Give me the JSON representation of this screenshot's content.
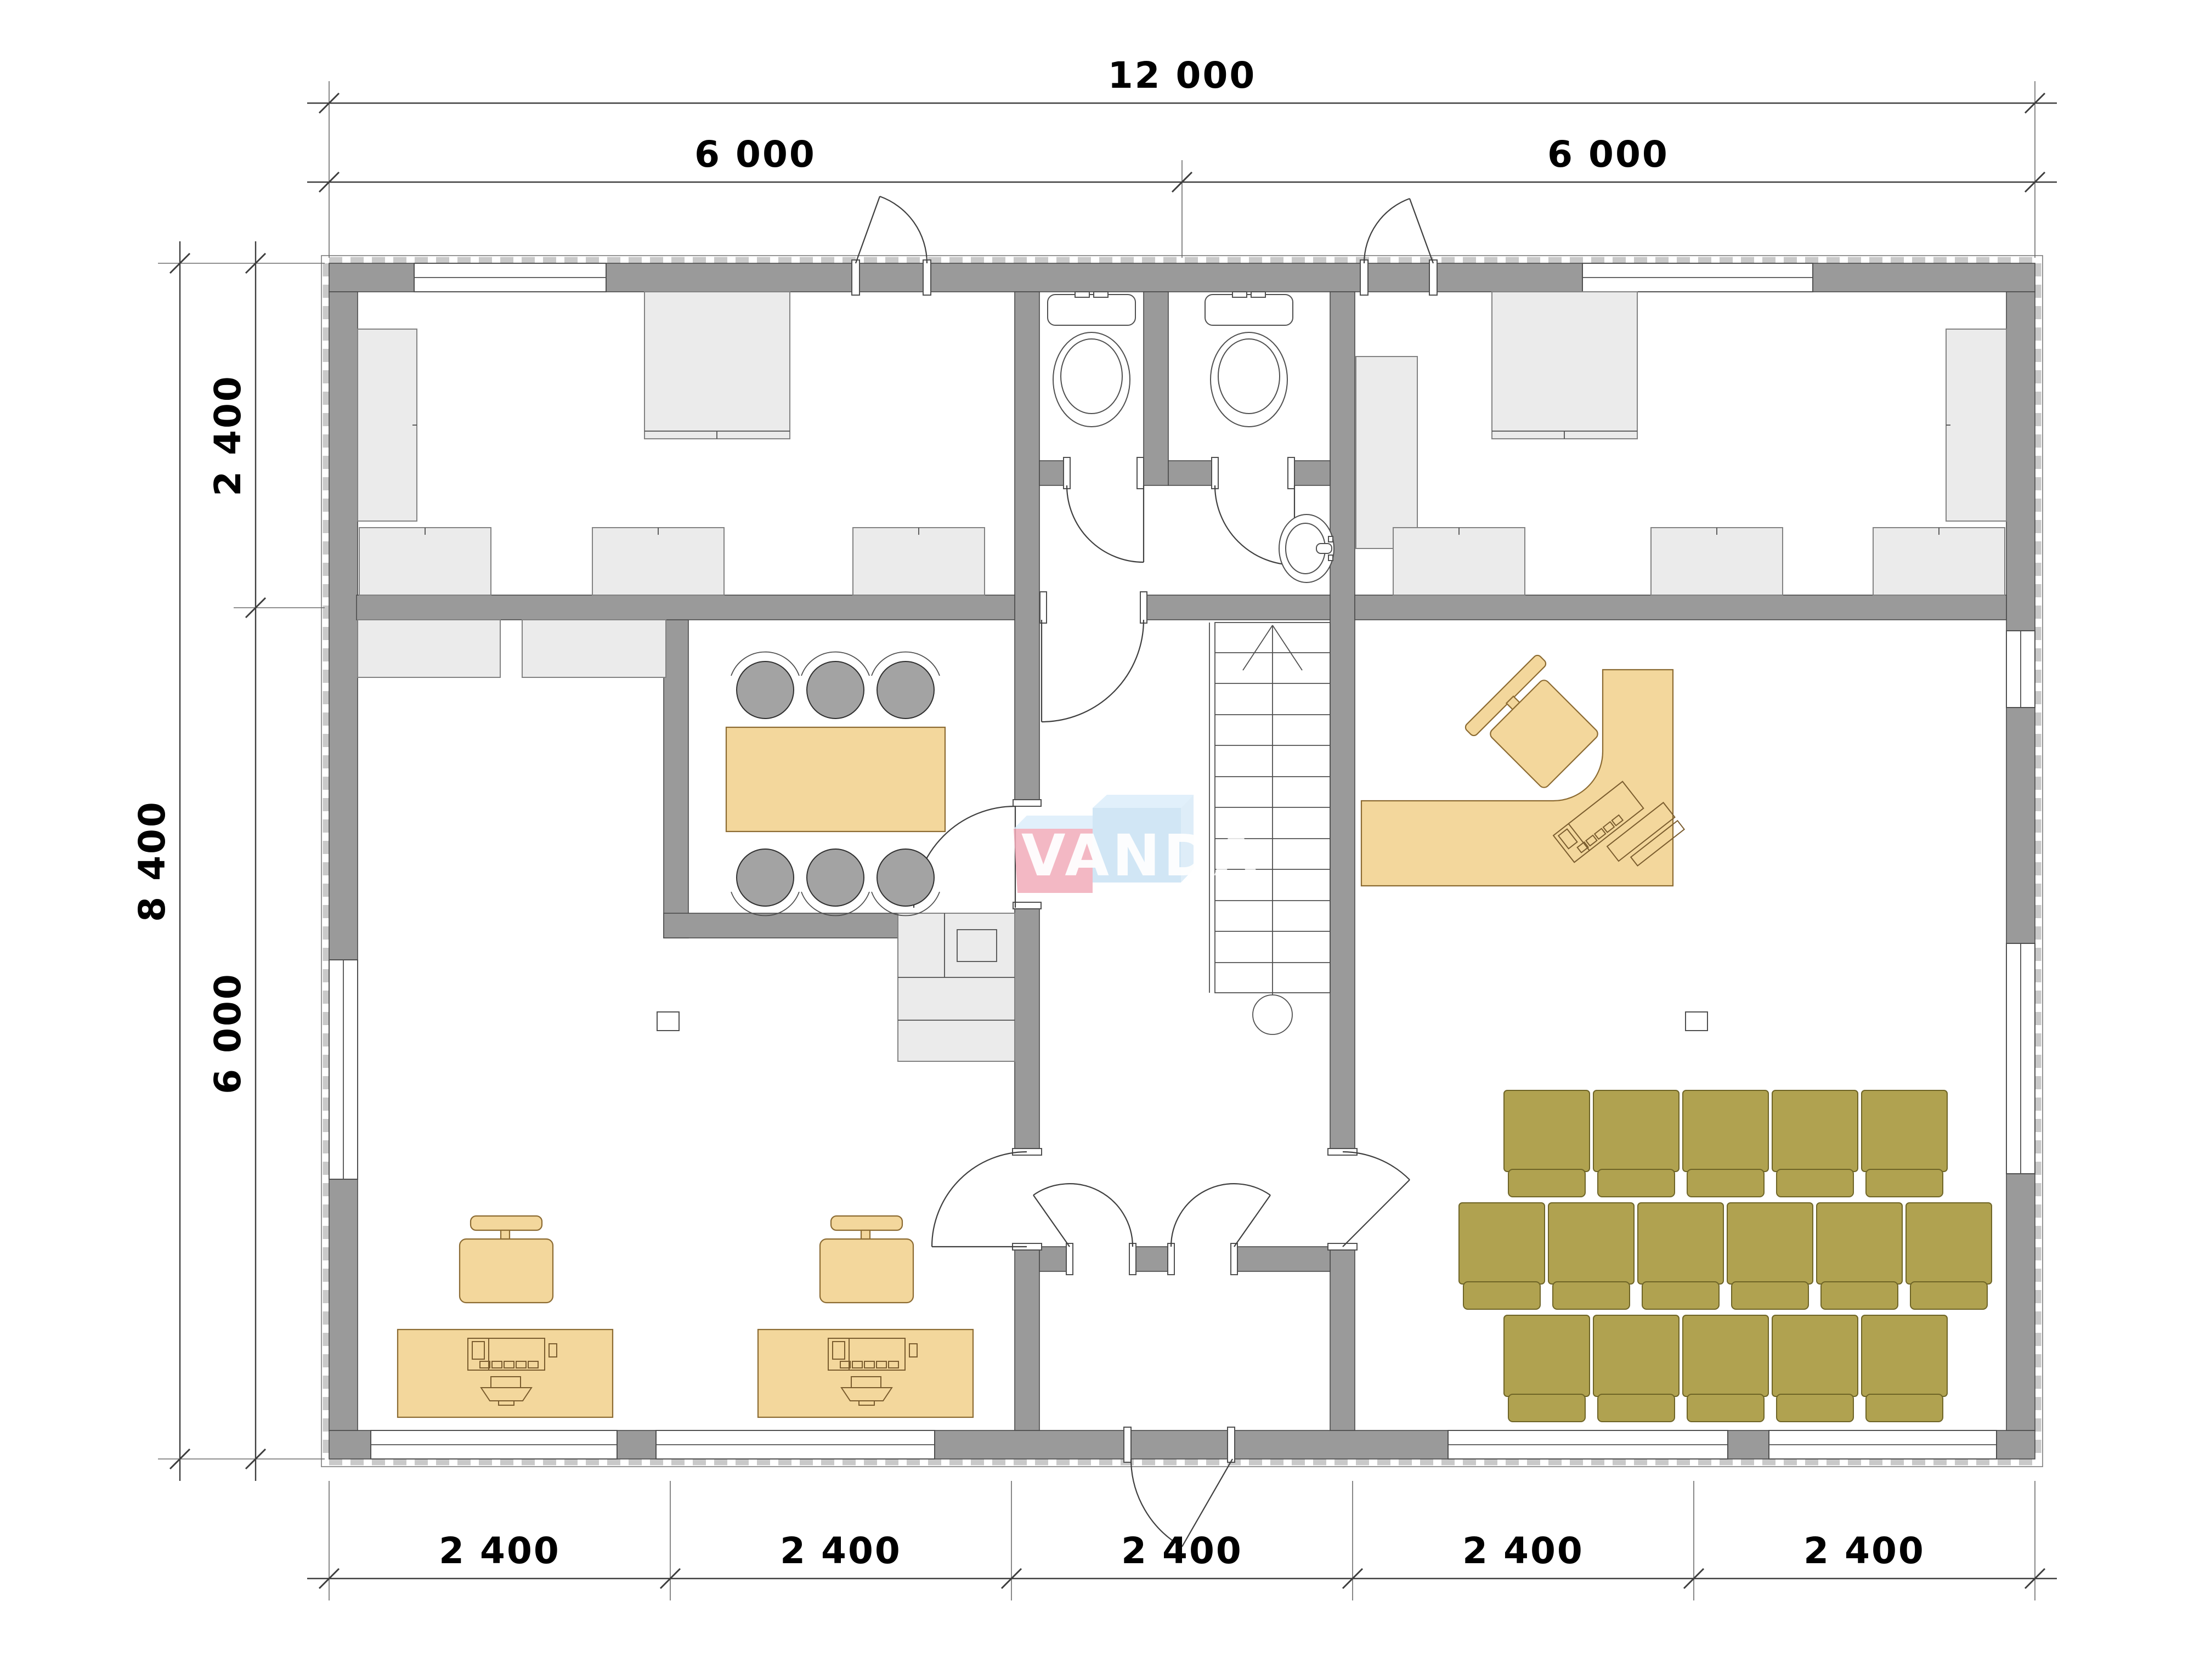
{
  "plan": {
    "type": "architectural-floor-plan",
    "building": {
      "width_mm": "12 000",
      "depth_mm": "8 400"
    },
    "features": [
      "two top offices with cabinets",
      "two toilet stalls with wash basin",
      "meeting room with table and six chairs",
      "kitchenette",
      "two computer workstations",
      "reception with L-shaped desk",
      "three rows of conference chairs",
      "staircase",
      "entrance vestibule"
    ]
  },
  "dimensions": {
    "top_total": "12 000",
    "top_left": "6 000",
    "top_right": "6 000",
    "side_total": "8 400",
    "side_top": "2 400",
    "side_bottom": "6 000",
    "bottom_segments": [
      "2 400",
      "2 400",
      "2 400",
      "2 400",
      "2 400"
    ]
  },
  "watermark": {
    "text": "VANDA",
    "pink": "#f2acba",
    "blue": "#c9e2f4",
    "bevel": "#dceefb"
  },
  "colors": {
    "wall": "#9a9a9a",
    "casework": "#ebebeb",
    "wood": "#f3d79c",
    "olive": "#b0a250",
    "chair_gray": "#a3a3a3"
  }
}
